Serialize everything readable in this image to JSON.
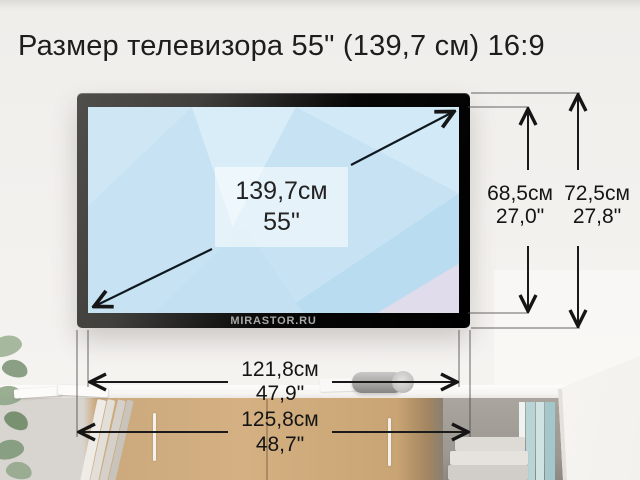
{
  "title": "Размер телевизора 55\" (139,7 см) 16:9",
  "tv": {
    "diagonal_cm": "139,7см",
    "diagonal_inch": "55\"",
    "watermark": "MIRASTOR.RU"
  },
  "dimensions": {
    "screen_height": {
      "cm": "68,5см",
      "inch": "27,0\""
    },
    "total_height": {
      "cm": "72,5см",
      "inch": "27,8\""
    },
    "screen_width": {
      "cm": "121,8см",
      "inch": "47,9\""
    },
    "total_width": {
      "cm": "125,8см",
      "inch": "48,7\""
    }
  },
  "colors": {
    "screen_blue": "#c7e3f3",
    "bezel_black": "#0b0b0b",
    "arrow_dark": "#1c1c1c",
    "wood": "#cba77a"
  }
}
